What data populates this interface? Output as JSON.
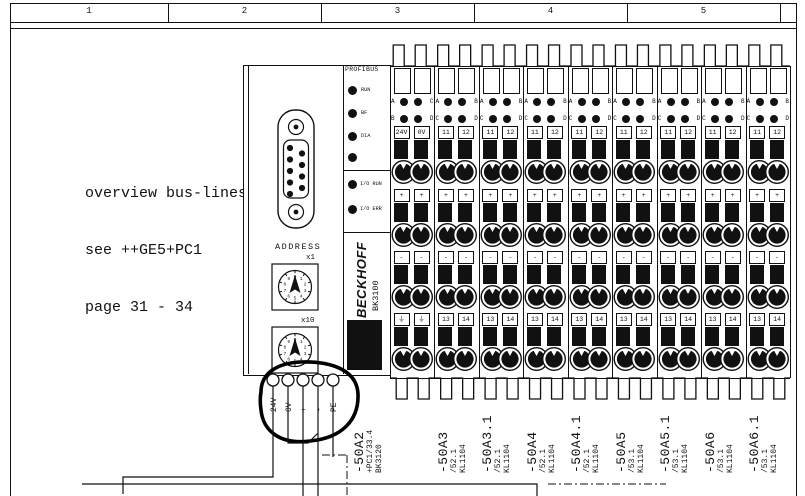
{
  "sheet": {
    "ruler_cells": [
      "1",
      "2",
      "3",
      "4",
      "5"
    ]
  },
  "note": {
    "line1": "overview bus-lines",
    "line2": "see ++GE5+PC1",
    "line3": "page 31 - 34"
  },
  "coupler": {
    "brand": "BECKHOFF",
    "model": "BK3100",
    "address_label": "ADDRESS",
    "switch1_label": "x1",
    "switch2_label": "x10",
    "switch_digits": [
      "0",
      "1",
      "2",
      "3",
      "4",
      "5",
      "6",
      "7",
      "8",
      "9"
    ],
    "power_terminals": [
      "24V",
      "0V",
      "+",
      "-",
      "PE"
    ],
    "profibus": {
      "title": "PROFIBUS",
      "led1": "RUN",
      "led2": "BF",
      "led3": "DIA",
      "io_led1": "I/O RUN",
      "io_led2": "I/O ERR"
    }
  },
  "strip": {
    "columns": [
      {
        "tag": "-50A2",
        "ref": "+PC1/33.4",
        "device": "BK3120",
        "leds": [
          [
            "A",
            "C"
          ],
          [
            "B",
            "D"
          ]
        ],
        "row1": [
          "24V",
          "0V"
        ],
        "row2": [
          "+",
          "+"
        ],
        "row3": [
          "-",
          "-"
        ],
        "row4": [
          "⏚",
          "⏚"
        ]
      },
      {
        "tag": "-50A3",
        "ref": "/52.1",
        "device": "KL1104",
        "leds": [
          [
            "A",
            "B"
          ],
          [
            "C",
            "D"
          ]
        ],
        "row1": [
          "11",
          "12"
        ],
        "row2": [
          "+",
          "+"
        ],
        "row3": [
          "-",
          "-"
        ],
        "row4": [
          "13",
          "14"
        ]
      },
      {
        "tag": "-50A3.1",
        "ref": "/52.1",
        "device": "KL1104",
        "leds": [
          [
            "A",
            "B"
          ],
          [
            "C",
            "D"
          ]
        ],
        "row1": [
          "11",
          "12"
        ],
        "row2": [
          "+",
          "+"
        ],
        "row3": [
          "-",
          "-"
        ],
        "row4": [
          "13",
          "14"
        ]
      },
      {
        "tag": "-50A4",
        "ref": "/52.1",
        "device": "KL1104",
        "leds": [
          [
            "A",
            "B"
          ],
          [
            "C",
            "D"
          ]
        ],
        "row1": [
          "11",
          "12"
        ],
        "row2": [
          "+",
          "+"
        ],
        "row3": [
          "-",
          "-"
        ],
        "row4": [
          "13",
          "14"
        ]
      },
      {
        "tag": "-50A4.1",
        "ref": "/52.1",
        "device": "KL1104",
        "leds": [
          [
            "A",
            "B"
          ],
          [
            "C",
            "D"
          ]
        ],
        "row1": [
          "11",
          "12"
        ],
        "row2": [
          "+",
          "+"
        ],
        "row3": [
          "-",
          "-"
        ],
        "row4": [
          "13",
          "14"
        ]
      },
      {
        "tag": "-50A5",
        "ref": "/53.1",
        "device": "KL1104",
        "leds": [
          [
            "A",
            "B"
          ],
          [
            "C",
            "D"
          ]
        ],
        "row1": [
          "11",
          "12"
        ],
        "row2": [
          "+",
          "+"
        ],
        "row3": [
          "-",
          "-"
        ],
        "row4": [
          "13",
          "14"
        ]
      },
      {
        "tag": "-50A5.1",
        "ref": "/53.1",
        "device": "KL1104",
        "leds": [
          [
            "A",
            "B"
          ],
          [
            "C",
            "D"
          ]
        ],
        "row1": [
          "11",
          "12"
        ],
        "row2": [
          "+",
          "+"
        ],
        "row3": [
          "-",
          "-"
        ],
        "row4": [
          "13",
          "14"
        ]
      },
      {
        "tag": "-50A6",
        "ref": "/53.1",
        "device": "KL1104",
        "leds": [
          [
            "A",
            "B"
          ],
          [
            "C",
            "D"
          ]
        ],
        "row1": [
          "11",
          "12"
        ],
        "row2": [
          "+",
          "+"
        ],
        "row3": [
          "-",
          "-"
        ],
        "row4": [
          "13",
          "14"
        ]
      },
      {
        "tag": "-50A6.1",
        "ref": "/53.1",
        "device": "KL1104",
        "leds": [
          [
            "A",
            "B"
          ],
          [
            "C",
            "D"
          ]
        ],
        "row1": [
          "11",
          "12"
        ],
        "row2": [
          "+",
          "+"
        ],
        "row3": [
          "-",
          "-"
        ],
        "row4": [
          "13",
          "14"
        ]
      }
    ]
  }
}
